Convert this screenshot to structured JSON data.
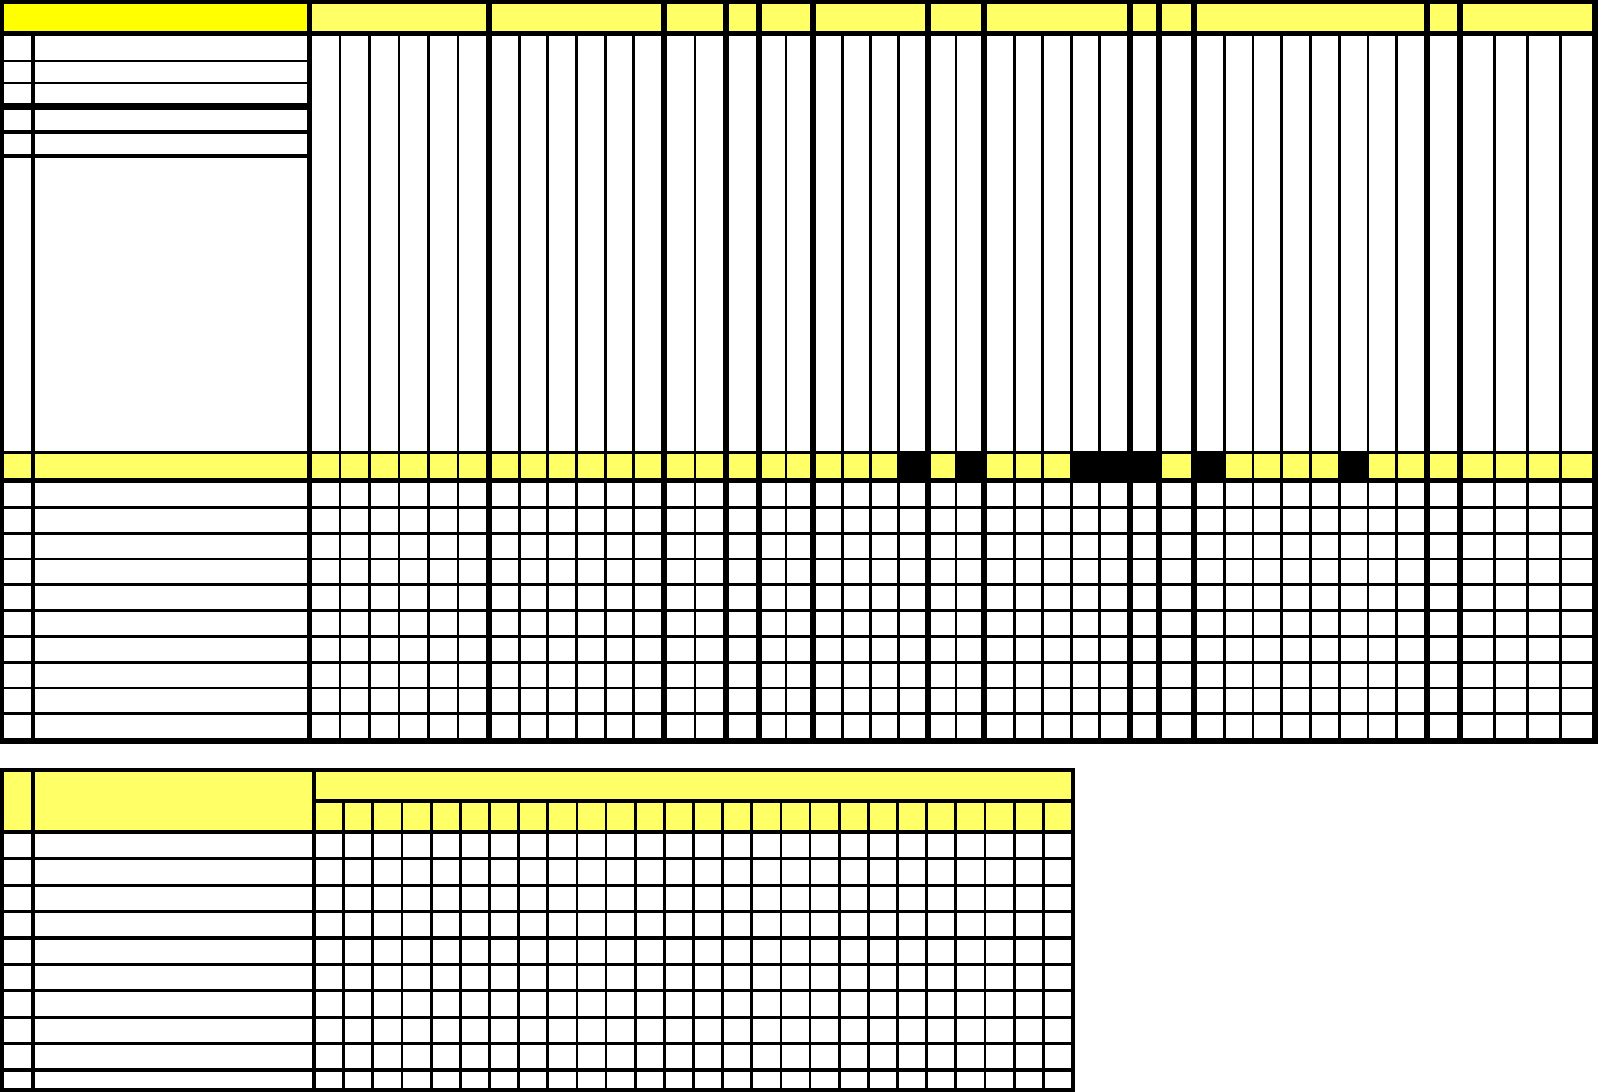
{
  "window": {
    "width": 1598,
    "height": 1092,
    "background": "#ffffff",
    "content_kind": "blank-spreadsheet-schedule-template",
    "visible_text": ""
  },
  "colors": {
    "grid_line": "#000000",
    "bright_yellow": "#ffff00",
    "pale_yellow": "#ffff66",
    "white": "#ffffff",
    "filled_cell": "#000000"
  },
  "main_table": {
    "frame": {
      "x": 0,
      "y": 0,
      "w": 1598,
      "h": 744
    },
    "header_band": {
      "y0": 4,
      "y1": 31
    },
    "title_cell": {
      "x0": 4,
      "x1": 307
    },
    "left_panel": {
      "narrow_col": {
        "x0": 4,
        "x1": 31
      },
      "wide_col": {
        "x0": 35,
        "x1": 307
      },
      "rows_y": [
        [
          36,
          60
        ],
        [
          62,
          82
        ],
        [
          84,
          103
        ],
        [
          110,
          130
        ],
        [
          134,
          154
        ],
        [
          158,
          451
        ]
      ]
    },
    "tall_area": {
      "y0": 36,
      "y1": 451
    },
    "marker_band": {
      "y0": 454,
      "y1": 478,
      "black_columns": [
        21,
        23,
        27,
        28,
        29,
        31,
        36
      ]
    },
    "grid": {
      "top": 483,
      "rows": 10,
      "pitch": 25.8,
      "cell_h": 23
    },
    "inner_gap": 2.8,
    "column_groups": [
      {
        "id": "g1",
        "cols": 6,
        "x0": 312,
        "x1": 486
      },
      {
        "id": "g2",
        "cols": 6,
        "x0": 492,
        "x1": 661
      },
      {
        "id": "g3",
        "cols": 2,
        "x0": 667,
        "x1": 723
      },
      {
        "id": "g4",
        "cols": 1,
        "x0": 729,
        "x1": 756
      },
      {
        "id": "g5",
        "cols": 2,
        "x0": 762,
        "x1": 810
      },
      {
        "id": "g6",
        "cols": 4,
        "x0": 816,
        "x1": 925
      },
      {
        "id": "g7",
        "cols": 2,
        "x0": 931,
        "x1": 981
      },
      {
        "id": "g8",
        "cols": 5,
        "x0": 987,
        "x1": 1127
      },
      {
        "id": "g9",
        "cols": 1,
        "x0": 1133,
        "x1": 1156
      },
      {
        "id": "g10",
        "cols": 1,
        "x0": 1162,
        "x1": 1191
      },
      {
        "id": "g11",
        "cols": 8,
        "x0": 1197,
        "x1": 1424
      },
      {
        "id": "g12",
        "cols": 1,
        "x0": 1430,
        "x1": 1457
      },
      {
        "id": "g13",
        "cols": 4,
        "x0": 1463,
        "x1": 1592
      }
    ]
  },
  "bottom_table": {
    "frame": {
      "x": 0,
      "y": 768,
      "w": 1075,
      "h": 324
    },
    "narrow_col": {
      "x0": 4,
      "x1": 31
    },
    "wide_col": {
      "x0": 35,
      "x1": 312
    },
    "small_cols": {
      "x0": 316,
      "x1": 1071,
      "count": 26,
      "gap": 2.8
    },
    "header": {
      "left_y": [
        772,
        830
      ],
      "merged_y": [
        772,
        799
      ],
      "sub_y": [
        803,
        830
      ]
    },
    "grid": {
      "top": 834,
      "rows": 10,
      "pitch": 26.4,
      "cell_h": 23.2,
      "clip_bottom": 1088
    }
  }
}
